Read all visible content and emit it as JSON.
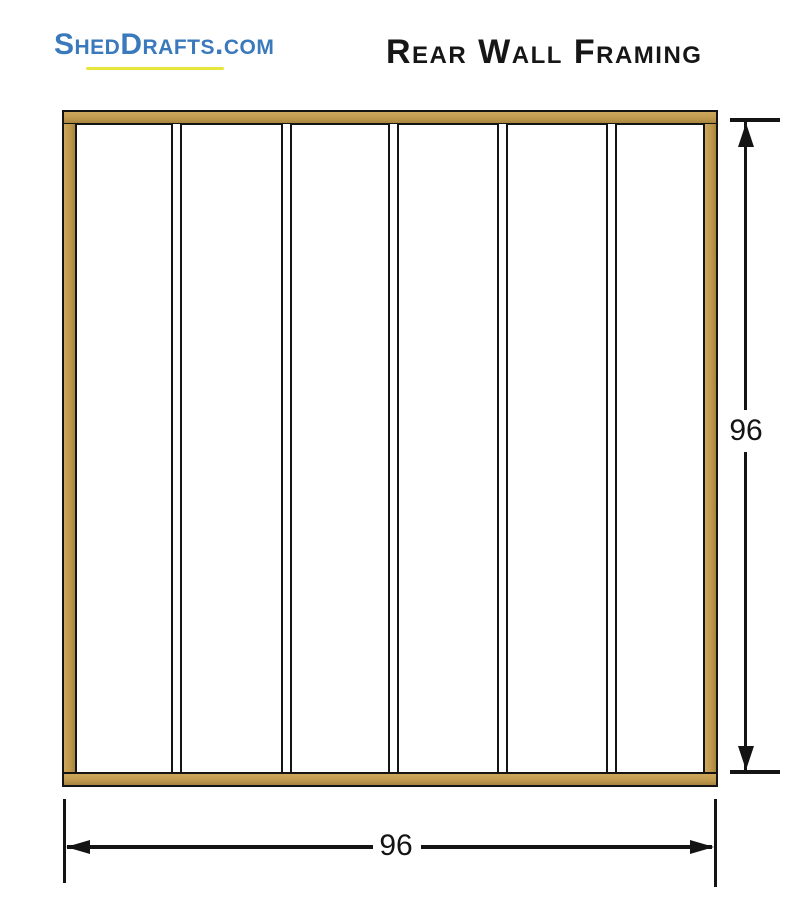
{
  "header": {
    "logo_text": "ShedDrafts.com",
    "title": "Rear Wall Framing"
  },
  "diagram": {
    "type": "wall-framing-plan",
    "wall": "rear",
    "height_dimension": "96",
    "width_dimension": "96",
    "stud_count": 7,
    "interior_stud_count": 5,
    "colors": {
      "lumber_light": "#CDA75C",
      "lumber_dark": "#A8853F",
      "outline_black": "#141414",
      "logo_blue": "#3A7ABC",
      "logo_underline_yellow": "#E8E63B",
      "background": "#FFFFFF"
    }
  }
}
